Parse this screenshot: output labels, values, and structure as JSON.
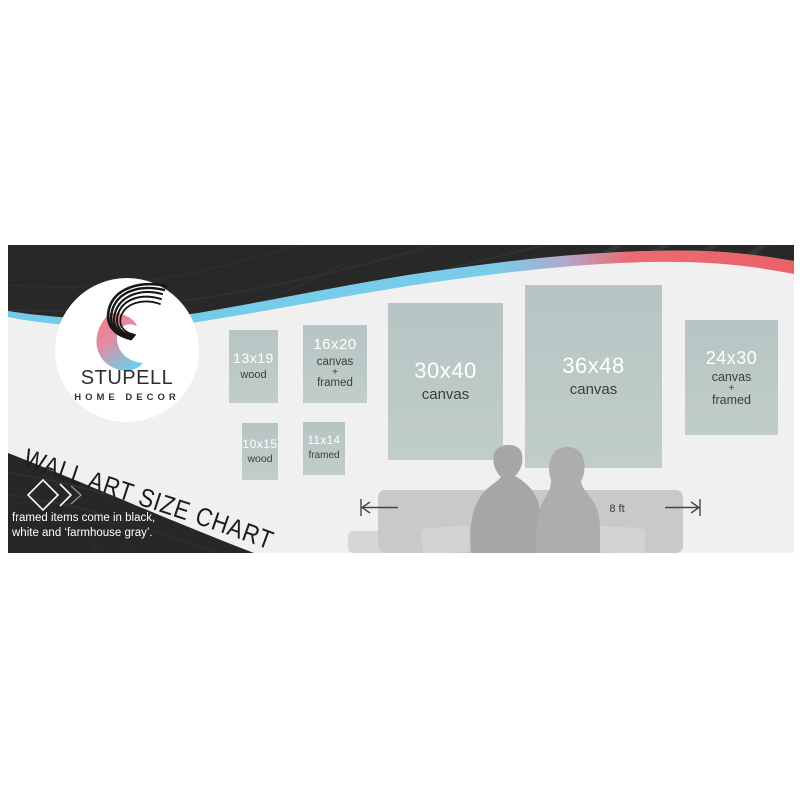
{
  "page": {
    "background": "#ffffff"
  },
  "banner": {
    "background": "#f0f0f1",
    "colors": {
      "dark_wave": "#282828",
      "accent_blue": "#74cce9",
      "accent_lavender": "#b4a6cb",
      "accent_red": "#ee6a70",
      "frame_fill": "#bac7c5",
      "couch_gray": "#c9c9c9",
      "silhouette_gray": "#a6a6a6"
    },
    "logo": {
      "name": "STUPELL",
      "subtitle": "HOME DECOR"
    },
    "title": "WALL ART SIZE CHART",
    "tagline_line1": "framed items come in black,",
    "tagline_line2": "white and ‘farmhouse gray’.",
    "frames": [
      {
        "size": "13x19",
        "material": "wood",
        "lines": [
          "13x19",
          "wood"
        ]
      },
      {
        "size": "16x20",
        "material": "canvas + framed",
        "lines": [
          "16x20",
          "canvas",
          "+",
          "framed"
        ]
      },
      {
        "size": "10x15",
        "material": "wood",
        "lines": [
          "10x15",
          "wood"
        ]
      },
      {
        "size": "11x14",
        "material": "framed",
        "lines": [
          "11x14",
          "framed"
        ]
      },
      {
        "size": "30x40",
        "material": "canvas",
        "lines": [
          "30x40",
          "canvas"
        ]
      },
      {
        "size": "36x48",
        "material": "canvas",
        "lines": [
          "36x48",
          "canvas"
        ]
      },
      {
        "size": "24x30",
        "material": "canvas + framed",
        "lines": [
          "24x30",
          "canvas",
          "+",
          "framed"
        ]
      }
    ],
    "scene": {
      "dimension_label": "8 ft"
    }
  }
}
